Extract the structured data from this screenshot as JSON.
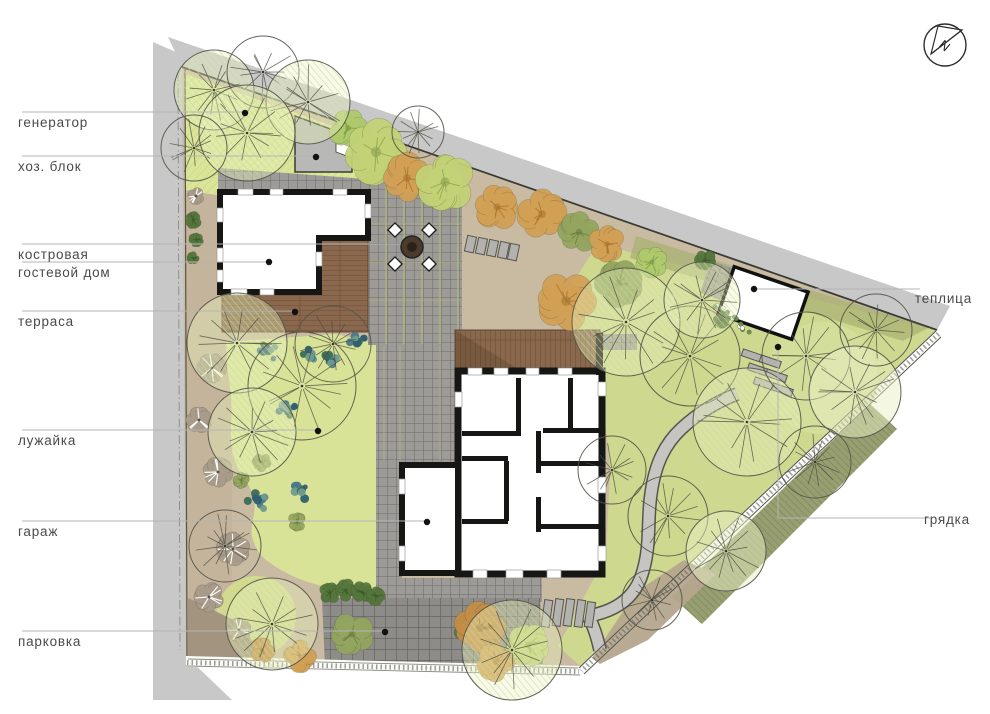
{
  "compass": {
    "letter": "N"
  },
  "labels": {
    "generator": "генератор",
    "utility_block": "хоз. блок",
    "fire_pit": "костровая",
    "guest_house": "гостевой дом",
    "terrace": "терраса",
    "lawn": "лужайка",
    "garage": "гараж",
    "parking": "парковка",
    "greenhouse": "теплица",
    "garden_bed": "грядка"
  },
  "colors": {
    "lawn": "#d8e297",
    "lawn_right": "#ced98f",
    "road": "#c8c8c8",
    "soil": "#c9baa2",
    "wood_deck": "#8a684d",
    "walls": "#161614",
    "paving": "#9d9b97",
    "olive_bed": "#8e9766",
    "annotation_line": "#b5b5b5",
    "dot": "#111111"
  }
}
